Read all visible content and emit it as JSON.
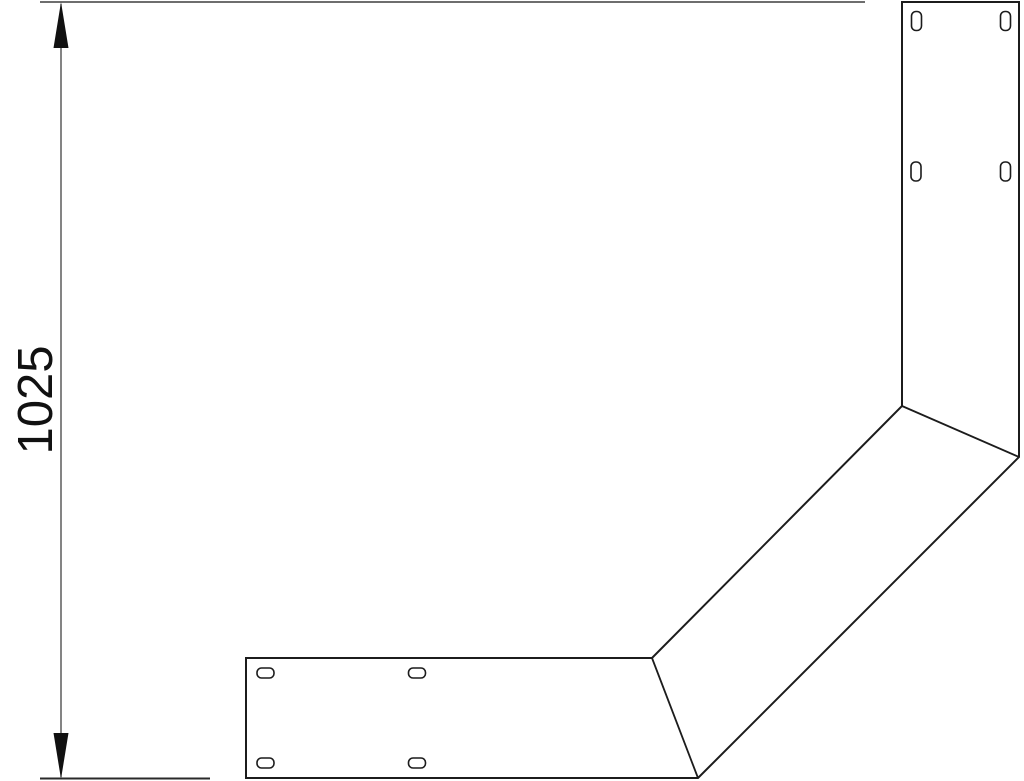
{
  "drawing": {
    "dimension_label": "1025",
    "colors": {
      "outline": "#1c1c1c",
      "dimension": "#111111",
      "extension_top": "#6e6e6e",
      "extension_bottom": "#2a2a2a",
      "background": "#ffffff"
    }
  }
}
